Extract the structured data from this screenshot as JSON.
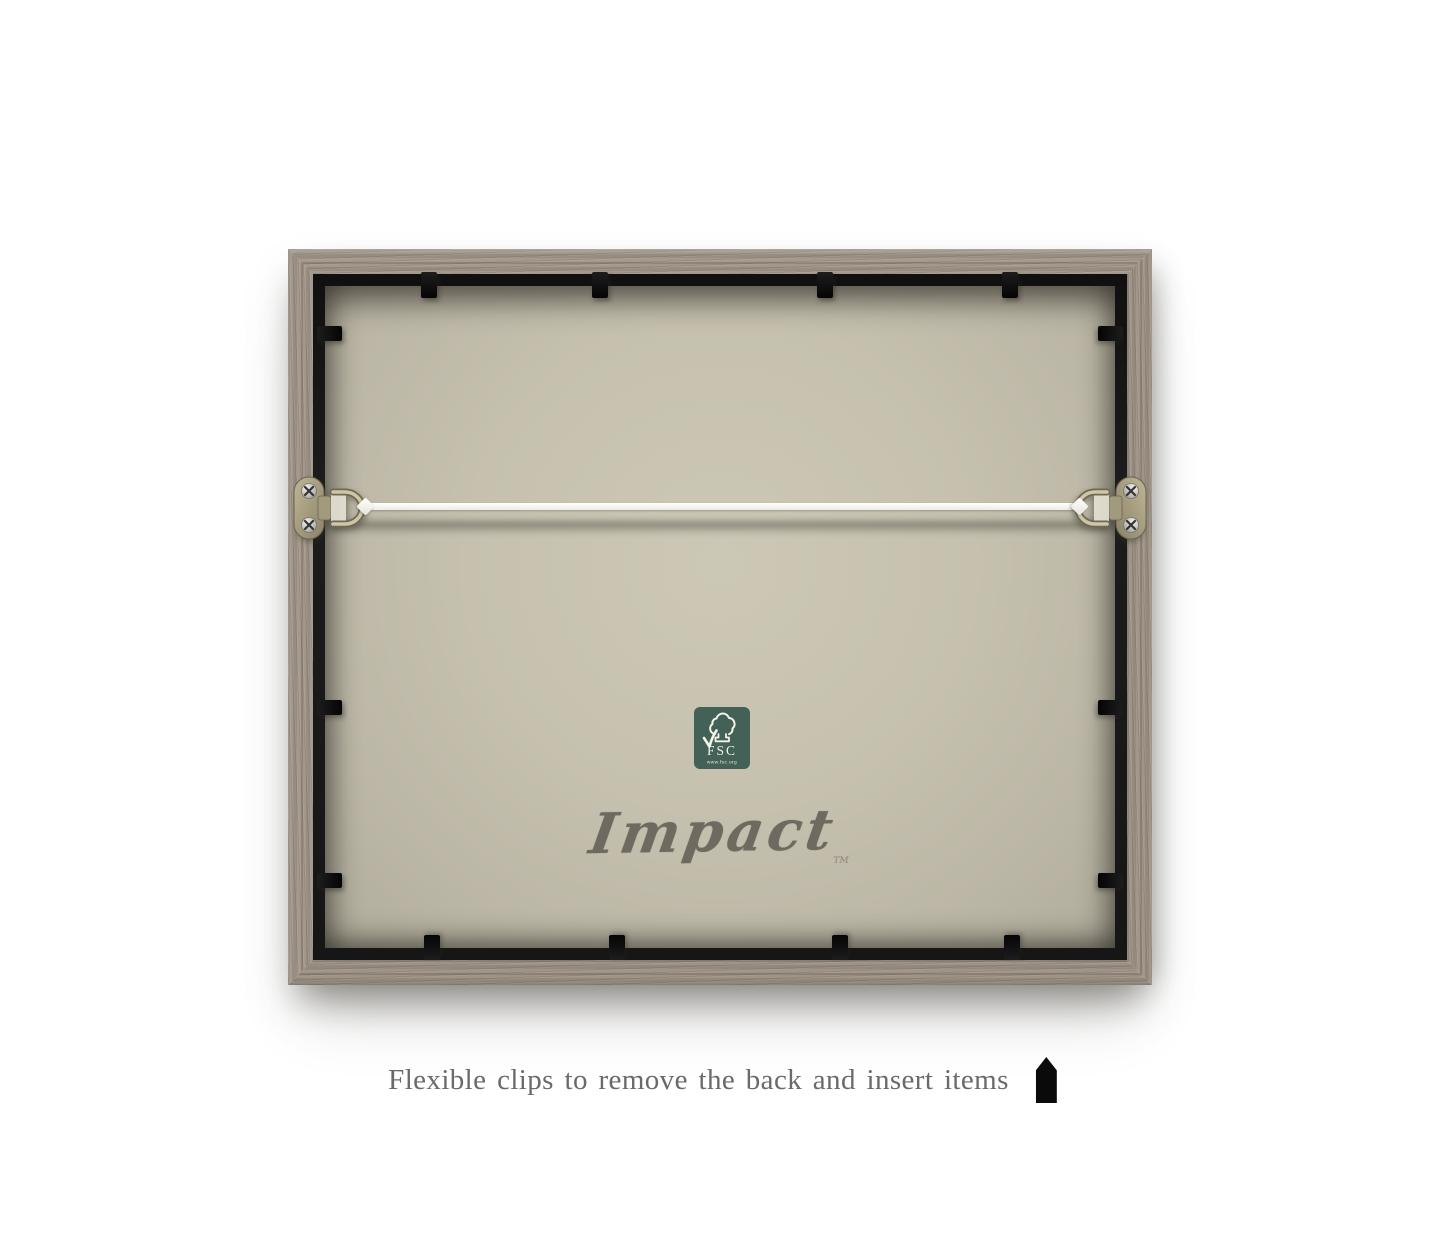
{
  "product": {
    "type": "picture-frame-back",
    "colors": {
      "wood": "#9b9083",
      "inner_lip": "#161616",
      "backing_center": "#cdc8b6",
      "backing_edge": "#b0ac9b",
      "clip": "#0e0e0e",
      "wire": "#f4f3ee",
      "brass_hardware": "#a89f82"
    },
    "clip_count": 14,
    "hanger_count": 2
  },
  "fsc_label": {
    "abbr": "FSC",
    "url": "www.fsc.org",
    "background": "#436156",
    "icon": "fsc-tree-checkmark"
  },
  "brand": {
    "name": "Impact",
    "trademark": "TM",
    "color": "#6e6a5f"
  },
  "caption": {
    "text": "Flexible clips to remove the back and insert items",
    "color": "#6a6a6a",
    "icon": "flexible-clip"
  }
}
